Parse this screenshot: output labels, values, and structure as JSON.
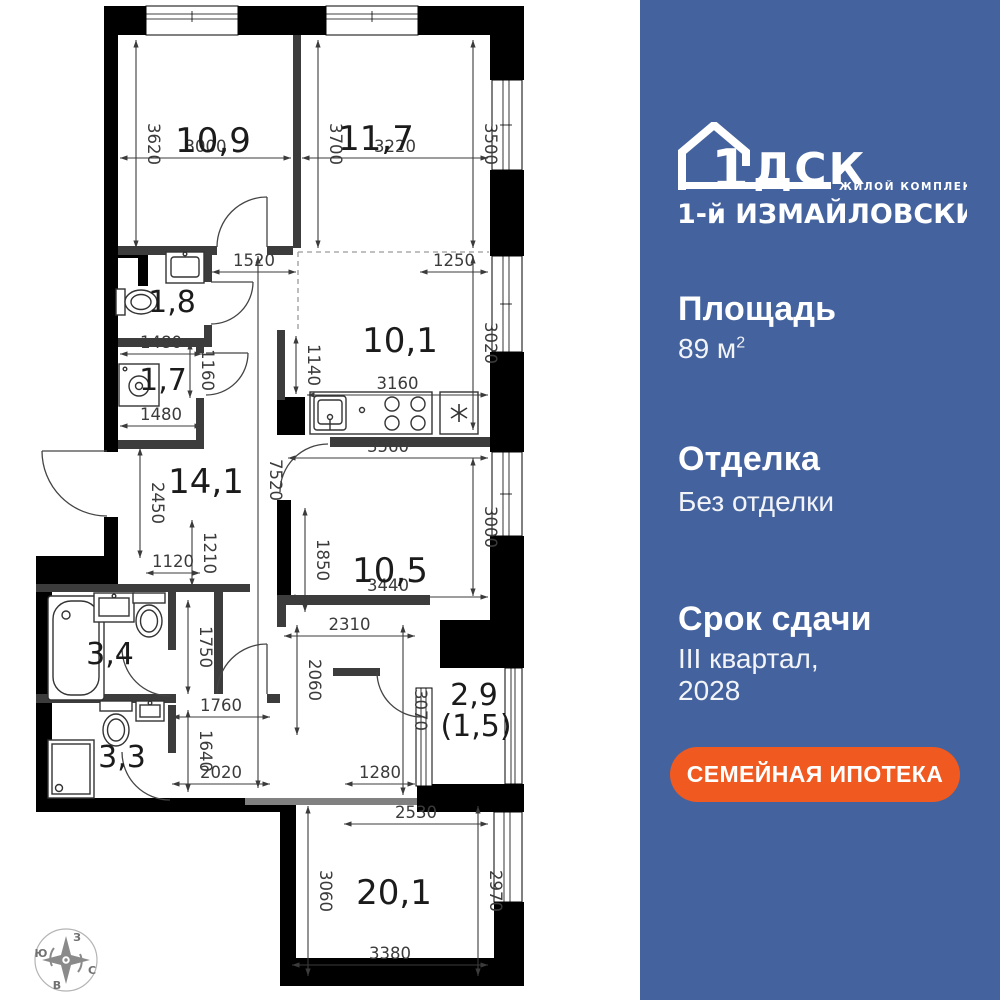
{
  "colors": {
    "panel_bg": "#44639E",
    "cta_bg": "#F0591F",
    "wall": "#000000",
    "inner_wall": "#3C3C3C",
    "dim_text": "#3B3B3B",
    "room_text": "#1B1B1B"
  },
  "panel": {
    "logo": {
      "brand_number": "1",
      "brand_letters": "ДСК",
      "tagline": "ЖИЛОЙ КОМПЛЕКС",
      "complex_name": "1-й ИЗМАЙЛОВСКИЙ"
    },
    "area": {
      "label": "Площадь",
      "value": "89 м",
      "sup": "2"
    },
    "finishing": {
      "label": "Отделка",
      "value": "Без отделки"
    },
    "deadline": {
      "label": "Срок сдачи",
      "value_line1": "III квартал,",
      "value_line2": "2028"
    },
    "cta": {
      "label": "СЕМЕЙНАЯ ИПОТЕКА"
    }
  },
  "plan": {
    "rooms": [
      {
        "label": "10,9",
        "x": 213,
        "y": 152,
        "fs": 34
      },
      {
        "label": "11,7",
        "x": 376,
        "y": 150,
        "fs": 34
      },
      {
        "label": "1,8",
        "x": 172,
        "y": 312,
        "fs": 30
      },
      {
        "label": "1,7",
        "x": 163,
        "y": 390,
        "fs": 30
      },
      {
        "label": "10,1",
        "x": 400,
        "y": 352,
        "fs": 34
      },
      {
        "label": "14,1",
        "x": 206,
        "y": 493,
        "fs": 34
      },
      {
        "label": "3,4",
        "x": 110,
        "y": 664,
        "fs": 30
      },
      {
        "label": "3,3",
        "x": 122,
        "y": 767,
        "fs": 30
      },
      {
        "label": "10,5",
        "x": 390,
        "y": 582,
        "fs": 34
      },
      {
        "label": "2,9",
        "x": 474,
        "y": 705,
        "fs": 30
      },
      {
        "label": "(1,5)",
        "x": 476,
        "y": 736,
        "fs": 30
      },
      {
        "label": "20,1",
        "x": 394,
        "y": 904,
        "fs": 34
      }
    ],
    "dims_h": [
      {
        "v": "3000",
        "x1": 120,
        "x2": 291,
        "y": 158
      },
      {
        "v": "3220",
        "x1": 302,
        "x2": 488,
        "y": 158
      },
      {
        "v": "1520",
        "x1": 212,
        "x2": 296,
        "y": 272
      },
      {
        "v": "1250",
        "x1": 420,
        "x2": 488,
        "y": 272
      },
      {
        "v": "1480",
        "x1": 120,
        "x2": 202,
        "y": 354
      },
      {
        "v": "1480",
        "x1": 120,
        "x2": 202,
        "y": 426
      },
      {
        "v": "3160",
        "x1": 307,
        "x2": 488,
        "y": 395
      },
      {
        "v": "3560",
        "x1": 288,
        "x2": 488,
        "y": 458
      },
      {
        "v": "1120",
        "x1": 146,
        "x2": 200,
        "y": 573
      },
      {
        "v": "3440",
        "x1": 288,
        "x2": 488,
        "y": 597
      },
      {
        "v": "2310",
        "x1": 284,
        "x2": 415,
        "y": 636
      },
      {
        "v": "1760",
        "x1": 172,
        "x2": 270,
        "y": 717
      },
      {
        "v": "2020",
        "x1": 172,
        "x2": 270,
        "y": 784
      },
      {
        "v": "1280",
        "x1": 345,
        "x2": 415,
        "y": 784
      },
      {
        "v": "2530",
        "x1": 344,
        "x2": 488,
        "y": 824
      },
      {
        "v": "3380",
        "x1": 292,
        "x2": 488,
        "y": 965
      }
    ],
    "dims_v": [
      {
        "v": "3620",
        "x": 136,
        "y1": 40,
        "y2": 248
      },
      {
        "v": "3700",
        "x": 318,
        "y1": 40,
        "y2": 248
      },
      {
        "v": "3500",
        "x": 473,
        "y1": 40,
        "y2": 248
      },
      {
        "v": "3020",
        "x": 473,
        "y1": 256,
        "y2": 430
      },
      {
        "v": "1140",
        "x": 296,
        "y1": 336,
        "y2": 394
      },
      {
        "v": "1160",
        "x": 190,
        "y1": 342,
        "y2": 398
      },
      {
        "v": "2450",
        "x": 140,
        "y1": 448,
        "y2": 558
      },
      {
        "v": "7520",
        "x": 258,
        "y1": 256,
        "y2": 788,
        "ly": 480
      },
      {
        "v": "1210",
        "x": 192,
        "y1": 520,
        "y2": 586
      },
      {
        "v": "1850",
        "x": 305,
        "y1": 508,
        "y2": 612
      },
      {
        "v": "3000",
        "x": 473,
        "y1": 458,
        "y2": 596
      },
      {
        "v": "1750",
        "x": 188,
        "y1": 600,
        "y2": 694
      },
      {
        "v": "2060",
        "x": 297,
        "y1": 625,
        "y2": 735
      },
      {
        "v": "3070",
        "x": 403,
        "y1": 625,
        "y2": 795
      },
      {
        "v": "1640",
        "x": 188,
        "y1": 710,
        "y2": 792
      },
      {
        "v": "3060",
        "x": 308,
        "y1": 806,
        "y2": 976
      },
      {
        "v": "2970",
        "x": 478,
        "y1": 806,
        "y2": 976
      }
    ],
    "compass": {
      "cx": 66,
      "cy": 960,
      "r": 31,
      "letters": [
        {
          "t": "З",
          "x": 77,
          "y": 941
        },
        {
          "t": "Ю",
          "x": 41,
          "y": 957
        },
        {
          "t": "С",
          "x": 92,
          "y": 974
        },
        {
          "t": "В",
          "x": 57,
          "y": 989
        }
      ]
    }
  }
}
